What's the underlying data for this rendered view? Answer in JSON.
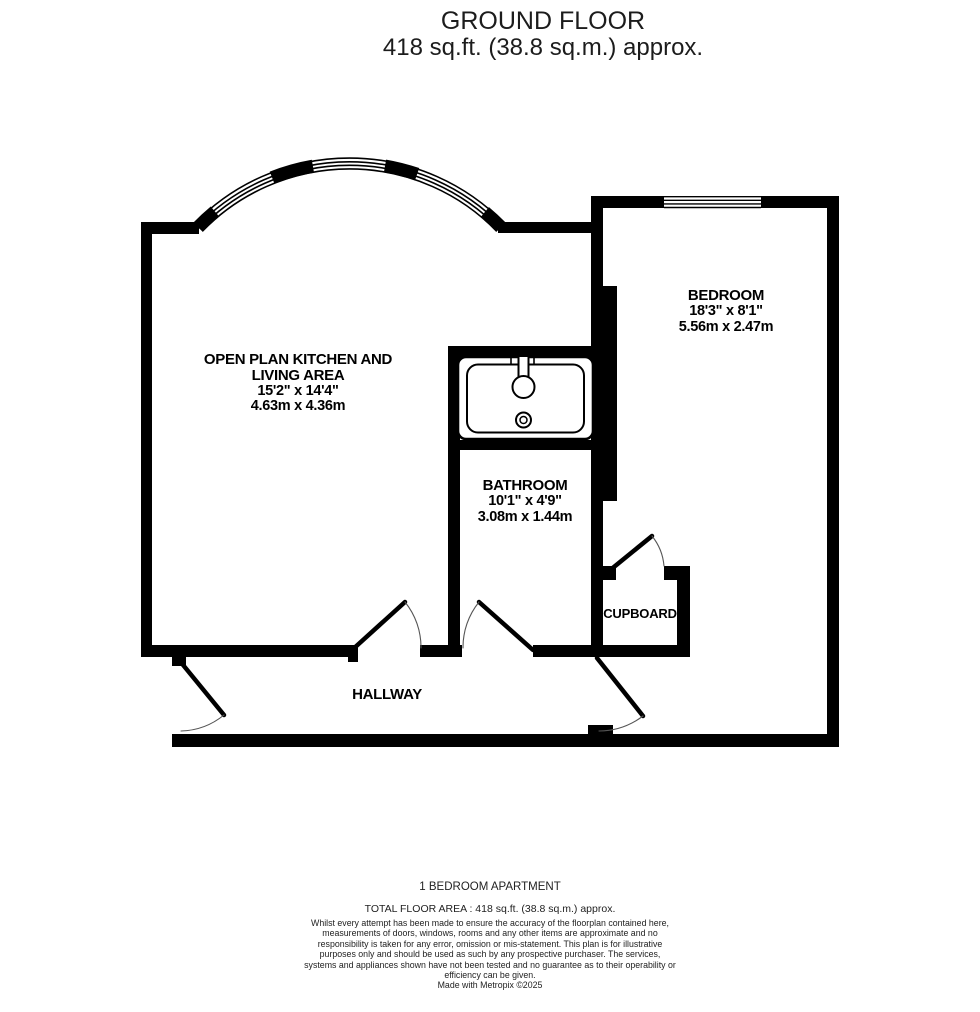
{
  "header": {
    "title": "GROUND FLOOR",
    "subtitle": "418 sq.ft. (38.8 sq.m.) approx."
  },
  "rooms": {
    "living": {
      "name_line1": "OPEN PLAN KITCHEN AND",
      "name_line2": "LIVING AREA",
      "imperial": "15'2\"  x 14'4\"",
      "metric": "4.63m  x 4.36m"
    },
    "bedroom": {
      "name": "BEDROOM",
      "imperial": "18'3\"  x 8'1\"",
      "metric": "5.56m  x 2.47m"
    },
    "bathroom": {
      "name": "BATHROOM",
      "imperial": "10'1\"  x 4'9\"",
      "metric": "3.08m  x 1.44m"
    },
    "cupboard": {
      "name": "CUPBOARD"
    },
    "hallway": {
      "name": "HALLWAY"
    }
  },
  "footer": {
    "property_type": "1 BEDROOM APARTMENT",
    "total_area": "TOTAL FLOOR AREA : 418 sq.ft. (38.8 sq.m.) approx.",
    "disclaimer": "Whilst every attempt has been made to ensure the accuracy of the floorplan contained here, measurements of doors, windows, rooms and any other items are approximate and no responsibility is taken for any error, omission or mis-statement. This plan is for illustrative purposes only and should be used as such by any prospective purchaser. The services, systems and appliances shown have not been tested and no guarantee as to their operability or efficiency can be given.",
    "credit": "Made with Metropix ©2025"
  },
  "colors": {
    "wall": "#000000",
    "background": "#ffffff",
    "text": "#1a1a1a"
  }
}
